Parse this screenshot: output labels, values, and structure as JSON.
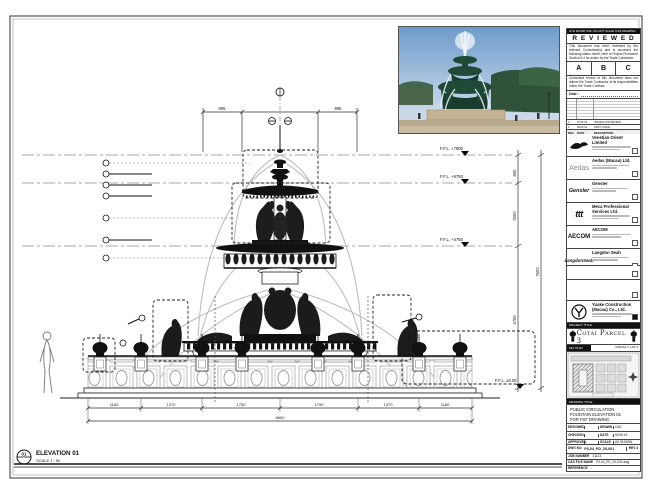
{
  "stamp": {
    "top_note": "IF IN DOUBT ASK. DO NOT SCALE THIS DRAWING.",
    "title": "R E V I E W E D",
    "body1": "This document has been reviewed by the relevant Consultant(s) and is accorded the following status noted, refer to Project Procedure Section 5.4 for action by the Trade Contractor.",
    "grade_a": "A",
    "grade_b": "B",
    "grade_c": "C",
    "body2": "Consultant review of this document does not relieve the Trade Contractor of its responsibilities under the Trade Contract.",
    "date_label": "Date :",
    "rev_rows": [
      {
        "rev": "2",
        "date": "10.06.15",
        "desc": "ISSUED FOR REVIEW"
      },
      {
        "rev": "1",
        "date": "28.05.15",
        "desc": "FIRST ISSUE"
      }
    ],
    "rev_header": {
      "rev": "REV",
      "date": "DATE",
      "desc": "DESCRIPTION"
    }
  },
  "consultants": [
    {
      "logo_text": "",
      "name": "Venetian Orient Limited"
    },
    {
      "logo_text": "Aedas",
      "name": "Aedas (Macau) Ltd."
    },
    {
      "logo_text": "Gensler",
      "name": "Gensler"
    },
    {
      "logo_text": "ttt",
      "name": "Meca Professional Services Ltd."
    },
    {
      "logo_text": "AECOM",
      "name": "AECOM"
    },
    {
      "logo_text": "LangdonSeah",
      "name": "Langdon Seah"
    }
  ],
  "contractor": {
    "name": "Yuake Construction (Macau) Co., Ltd."
  },
  "project": {
    "label": "PROJECT TITLE",
    "title": "Cotai Parcel 3"
  },
  "key_plan": {
    "label": "KEY PLAN",
    "note": "PARCEL 3, LOT 3"
  },
  "title_block": {
    "bar": "DRAWING TITLE",
    "line1": "PUBLIC CIRCULATION",
    "line2": "FOUNTAIN ELEVATION 01",
    "line3": "FOR FSF DRAWING",
    "designed_label": "DESIGNED",
    "designed_value": "-",
    "drawn_label": "DRAWN",
    "drawn_value": "CAD",
    "checked_label": "CHECKED",
    "checked_value": "-",
    "date_label": "DATE",
    "date_value": "05.06.15",
    "approved_label": "APPROVED",
    "approved_value": "-",
    "scale_label": "SCALE",
    "scale_value": "AS SHOWN",
    "dwg_label": "DWG NO.",
    "dwg_value": "P3-04_PD_20-001",
    "rev_value": "REV 3",
    "job_label": "JOB NUMBER",
    "job_value": "31123",
    "cad_label": "CAD FILE NAME",
    "cad_value": "P3-04_PD_20-001.dwg",
    "ref_label": "REFERENCE",
    "ref_value": "-"
  },
  "drawing": {
    "levels": [
      "F.F.L. +7600",
      "F.F.L. +6750",
      "F.F.L. +4750",
      "F.F.L. ±0.00"
    ],
    "dims_top": [
      "895",
      "895"
    ],
    "dims_right": [
      "850",
      "2000",
      "4750",
      "7600"
    ],
    "dims_bottom": [
      "1180",
      "1370",
      "1750",
      "1750",
      "1370",
      "1180"
    ],
    "dims_bottom_total": "8600",
    "elevation_number": "01",
    "elevation_title": "ELEVATION 01",
    "elevation_scale": "SCALE 1 : 50"
  }
}
